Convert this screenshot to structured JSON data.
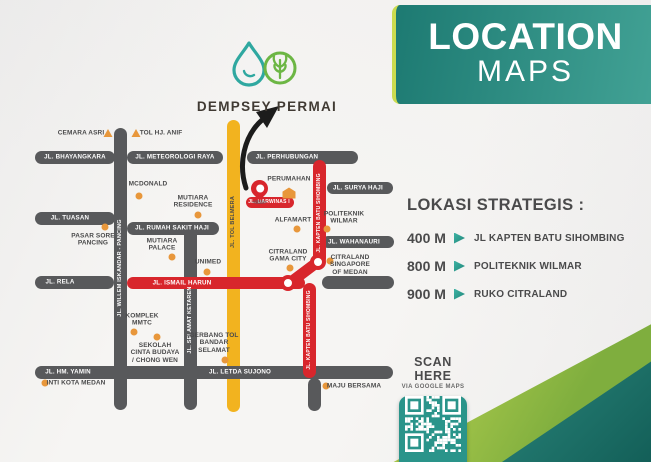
{
  "brand": {
    "name": "DEMPSEY PERMAI"
  },
  "header": {
    "line1": "LOCATION",
    "line2": "MAPS"
  },
  "strategic": {
    "heading": "LOKASI STRATEGIS :",
    "items": [
      {
        "distance": "400 M",
        "label": "JL KAPTEN BATU SIHOMBING"
      },
      {
        "distance": "800 M",
        "label": "POLITEKNIK WILMAR"
      },
      {
        "distance": "900 M",
        "label": "RUKO CITRALAND"
      }
    ]
  },
  "scan": {
    "title": "SCAN HERE",
    "subtitle": "VIA GOOGLE MAPS"
  },
  "colors": {
    "header_teal_dark": "#1d7a72",
    "header_teal_light": "#42a295",
    "lime_accent": "#cbdb4f",
    "road_gray": "#58595b",
    "road_red": "#d8262c",
    "road_yellow": "#f2b31f",
    "poi_orange": "#e8973b",
    "text_dark": "#4a4a4b",
    "qr_teal": "#2a948a",
    "logo_teal": "#2fa8a0",
    "logo_green": "#6cb644"
  },
  "map": {
    "roads": [
      {
        "id": "tol-belmera",
        "color": "yellow",
        "x": 227,
        "y": 120,
        "w": 13,
        "h": 292
      },
      {
        "id": "bhayangkara",
        "color": "gray",
        "x": 35,
        "y": 151,
        "w": 80,
        "h": 13
      },
      {
        "id": "meteorologi-raya",
        "color": "gray",
        "x": 127,
        "y": 151,
        "w": 96,
        "h": 13
      },
      {
        "id": "perhubungan",
        "color": "gray",
        "x": 247,
        "y": 151,
        "w": 111,
        "h": 13
      },
      {
        "id": "tuasan",
        "color": "gray",
        "x": 35,
        "y": 212,
        "w": 80,
        "h": 13
      },
      {
        "id": "rumah-sakit-haji",
        "color": "gray",
        "x": 127,
        "y": 222,
        "w": 92,
        "h": 13
      },
      {
        "id": "rela",
        "color": "gray",
        "x": 35,
        "y": 276,
        "w": 79,
        "h": 13
      },
      {
        "id": "surya-haji",
        "color": "gray",
        "x": 327,
        "y": 182,
        "w": 66,
        "h": 12
      },
      {
        "id": "wahanauri",
        "color": "gray",
        "x": 322,
        "y": 236,
        "w": 72,
        "h": 12
      },
      {
        "id": "citraland-access",
        "color": "gray",
        "x": 322,
        "y": 276,
        "w": 72,
        "h": 13
      },
      {
        "id": "hm-yamin-letda-sujono",
        "color": "gray",
        "x": 35,
        "y": 366,
        "w": 358,
        "h": 13
      },
      {
        "id": "willem-iskandar",
        "color": "gray",
        "x": 114,
        "y": 128,
        "w": 13,
        "h": 282
      },
      {
        "id": "selamat-ketaren",
        "color": "gray",
        "x": 184,
        "y": 228,
        "w": 13,
        "h": 182
      },
      {
        "id": "letda-stub",
        "color": "gray",
        "x": 308,
        "y": 378,
        "w": 13,
        "h": 33
      },
      {
        "id": "ismail-harun",
        "color": "red",
        "x": 127,
        "y": 277,
        "w": 178,
        "h": 12
      },
      {
        "id": "darwinas",
        "color": "red",
        "x": 246,
        "y": 197,
        "w": 48,
        "h": 11
      },
      {
        "id": "kapten-batu-sihombing-utara",
        "color": "red",
        "x": 313,
        "y": 160,
        "w": 13,
        "h": 105
      },
      {
        "id": "kapten-connector",
        "color": "red",
        "x": 289,
        "y": 278,
        "w": 40,
        "h": 11,
        "rot": -37
      },
      {
        "id": "kapten-batu-sihombing-selatan",
        "color": "red",
        "x": 303,
        "y": 283,
        "w": 13,
        "h": 95
      }
    ],
    "rings": [
      {
        "x": 318,
        "y": 262
      },
      {
        "x": 288,
        "y": 283
      }
    ],
    "road_labels": [
      {
        "text": "JL. BHAYANGKARA",
        "x": 75,
        "y": 157
      },
      {
        "text": "JL. METEOROLOGI RAYA",
        "x": 175,
        "y": 157
      },
      {
        "text": "JL. PERHUBUNGAN",
        "x": 287,
        "y": 157
      },
      {
        "text": "JL. TUASAN",
        "x": 70,
        "y": 218
      },
      {
        "text": "JL. RUMAH SAKIT HAJI",
        "x": 172,
        "y": 228
      },
      {
        "text": "JL. RELA",
        "x": 60,
        "y": 282
      },
      {
        "text": "JL. SURYA HAJI",
        "x": 358,
        "y": 188
      },
      {
        "text": "JL. WAHANAURI",
        "x": 354,
        "y": 242
      },
      {
        "text": "JL. HM. YAMIN",
        "x": 68,
        "y": 372
      },
      {
        "text": "JL. LETDA SUJONO",
        "x": 240,
        "y": 372
      },
      {
        "text": "JL. ISMAIL HARUN",
        "x": 182,
        "y": 283
      },
      {
        "text": "JL. DARWINAS I",
        "x": 269,
        "y": 202,
        "size": 5
      },
      {
        "text": "JL. KAPTEN BATU SIHOMBING",
        "x": 319,
        "y": 213,
        "orient": "v",
        "size": 5
      },
      {
        "text": "JL. KAPTEN BATU SIHOMBING",
        "x": 309,
        "y": 330,
        "orient": "v",
        "size": 5
      },
      {
        "text": "JL. WILLEM ISKANDAR - PANCING",
        "x": 120,
        "y": 268,
        "orient": "v"
      },
      {
        "text": "JL. SELAMAT KETAREN",
        "x": 190,
        "y": 320,
        "orient": "v"
      },
      {
        "text": "JL. TOL BELMERA",
        "x": 233,
        "y": 222,
        "orient": "v",
        "theme": "dark"
      }
    ],
    "pois": [
      {
        "id": "cemara-asri",
        "lines": [
          "CEMARA ASRI"
        ],
        "tx": 81,
        "ty": 133,
        "marker": "tri",
        "mx": 108,
        "my": 133
      },
      {
        "id": "tol-hj-anif",
        "lines": [
          "TOL HJ. ANIF"
        ],
        "tx": 161,
        "ty": 133,
        "marker": "tri",
        "mx": 136,
        "my": 133
      },
      {
        "id": "mcdonald",
        "lines": [
          "MCDONALD"
        ],
        "tx": 148,
        "ty": 184,
        "marker": "dot",
        "mx": 139,
        "my": 196
      },
      {
        "id": "mutiara-residence",
        "lines": [
          "MUTIARA",
          "RESIDENCE"
        ],
        "tx": 193,
        "ty": 202,
        "marker": "dot",
        "mx": 198,
        "my": 215
      },
      {
        "id": "mutiara-palace",
        "lines": [
          "MUTIARA",
          "PALACE"
        ],
        "tx": 162,
        "ty": 245,
        "marker": "dot",
        "mx": 172,
        "my": 257
      },
      {
        "id": "pasar-sore-pancing",
        "lines": [
          "PASAR SORE",
          "PANCING"
        ],
        "tx": 93,
        "ty": 240,
        "marker": "dot",
        "mx": 105,
        "my": 227
      },
      {
        "id": "unimed",
        "lines": [
          "UNIMED"
        ],
        "tx": 208,
        "ty": 262,
        "marker": "dot",
        "mx": 207,
        "my": 272
      },
      {
        "id": "komplek-mmtc",
        "lines": [
          "KOMPLEK",
          "MMTC"
        ],
        "tx": 142,
        "ty": 320,
        "marker": "dot",
        "mx": 134,
        "my": 332
      },
      {
        "id": "sekolah-cinta-budaya",
        "lines": [
          "SEKOLAH",
          "CINTA BUDAYA",
          "/ CHONG WEN"
        ],
        "tx": 155,
        "ty": 353,
        "marker": "dot",
        "mx": 157,
        "my": 337
      },
      {
        "id": "inti-kota-medan",
        "lines": [
          "INTI KOTA MEDAN"
        ],
        "tx": 76,
        "ty": 383,
        "marker": "dot",
        "mx": 45,
        "my": 383
      },
      {
        "id": "gerbang-tol-bandar-selamat",
        "lines": [
          "GERBANG TOL",
          "BANDAR",
          "SELAMAT"
        ],
        "tx": 214,
        "ty": 343,
        "marker": "dot",
        "mx": 225,
        "my": 360
      },
      {
        "id": "maju-bersama",
        "lines": [
          "MAJU BERSAMA"
        ],
        "tx": 354,
        "ty": 386,
        "marker": "dot",
        "mx": 326,
        "my": 386
      },
      {
        "id": "perumahan",
        "lines": [
          "PERUMAHAN"
        ],
        "tx": 289,
        "ty": 179,
        "marker": "house",
        "mx": 289,
        "my": 193
      },
      {
        "id": "alfamart",
        "lines": [
          "ALFAMART"
        ],
        "tx": 293,
        "ty": 220,
        "marker": "dot",
        "mx": 297,
        "my": 229
      },
      {
        "id": "politeknik-wilmar",
        "lines": [
          "POLITEKNIK",
          "WILMAR"
        ],
        "tx": 344,
        "ty": 218,
        "marker": "dot",
        "mx": 327,
        "my": 229
      },
      {
        "id": "citraland-singapore-of-medan",
        "lines": [
          "CITRALAND",
          "SINGAPORE",
          "OF MEDAN"
        ],
        "tx": 350,
        "ty": 265,
        "marker": "dot",
        "mx": 330,
        "my": 261
      },
      {
        "id": "citraland-gama-city",
        "lines": [
          "CITRALAND",
          "GAMA CITY"
        ],
        "tx": 288,
        "ty": 256,
        "marker": "dot",
        "mx": 290,
        "my": 268
      }
    ]
  }
}
